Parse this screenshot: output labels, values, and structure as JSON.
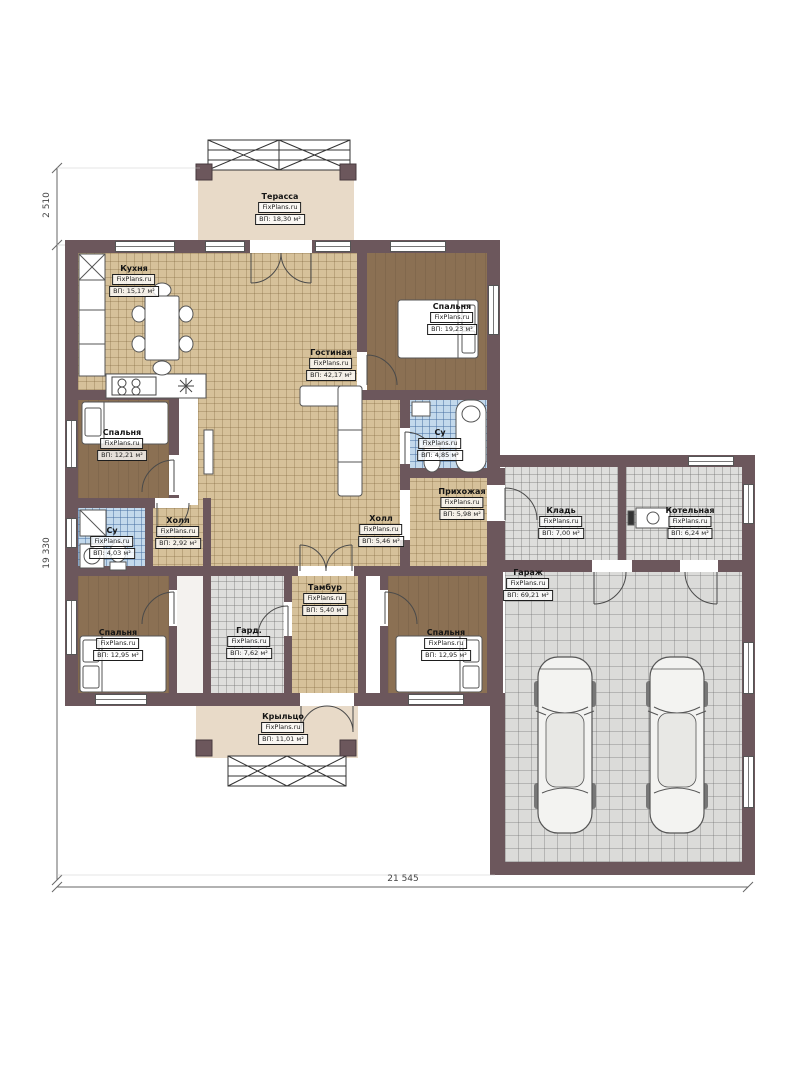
{
  "brand": "FixPlans.ru",
  "dimensions": {
    "terrace_height": "2 510",
    "left_height": "19 330",
    "bottom_width": "21 545"
  },
  "rooms": {
    "terrace": {
      "name": "Терасса",
      "site": "FixPlans.ru",
      "area": "ВП: 18,30 м²"
    },
    "kitchen": {
      "name": "Кухня",
      "site": "FixPlans.ru",
      "area": "ВП: 15,17 м²"
    },
    "living": {
      "name": "Гостиная",
      "site": "FixPlans.ru",
      "area": "ВП: 42,17 м²"
    },
    "bedroom_tr": {
      "name": "Спальня",
      "site": "FixPlans.ru",
      "area": "ВП: 19,23 м²"
    },
    "bedroom_l": {
      "name": "Спальня",
      "site": "FixPlans.ru",
      "area": "ВП: 12,21 м²"
    },
    "bath_r": {
      "name": "Су",
      "site": "FixPlans.ru",
      "area": "ВП: 4,85 м²"
    },
    "hallway": {
      "name": "Прихожая",
      "site": "FixPlans.ru",
      "area": "ВП: 5,98 м²"
    },
    "hall_l": {
      "name": "Холл",
      "site": "FixPlans.ru",
      "area": "ВП: 2,92 м²"
    },
    "hall_c": {
      "name": "Холл",
      "site": "FixPlans.ru",
      "area": "ВП: 5,46 м²"
    },
    "bath_l": {
      "name": "Су",
      "site": "FixPlans.ru",
      "area": "ВП: 4,03 м²"
    },
    "tambour": {
      "name": "Тамбур",
      "site": "FixPlans.ru",
      "area": "ВП: 5,40 м²"
    },
    "wardrobe": {
      "name": "Гард.",
      "site": "FixPlans.ru",
      "area": "ВП: 7,62 м²"
    },
    "bedroom_bl": {
      "name": "Спальня",
      "site": "FixPlans.ru",
      "area": "ВП: 12,95 м²"
    },
    "bedroom_br": {
      "name": "Спальня",
      "site": "FixPlans.ru",
      "area": "ВП: 12,95 м²"
    },
    "porch": {
      "name": "Крыльцо",
      "site": "FixPlans.ru",
      "area": "ВП: 11,01 м²"
    },
    "storage": {
      "name": "Кладь",
      "site": "FixPlans.ru",
      "area": "ВП: 7,00 м²"
    },
    "boiler_room": {
      "name": "Котельная",
      "site": "FixPlans.ru",
      "area": "ВП: 6,24 м²"
    },
    "garage": {
      "name": "Гараж",
      "site": "FixPlans.ru",
      "area": "ВП: 69,21 м²"
    }
  },
  "colors": {
    "wall": "#6c575c",
    "tile_beige": "#d6c19a",
    "terrace": "#e8dac8",
    "bedroom_floor": "#8b7053",
    "bath_tile": "#c3d9ec",
    "garage_tile": "#dbdbd9"
  }
}
